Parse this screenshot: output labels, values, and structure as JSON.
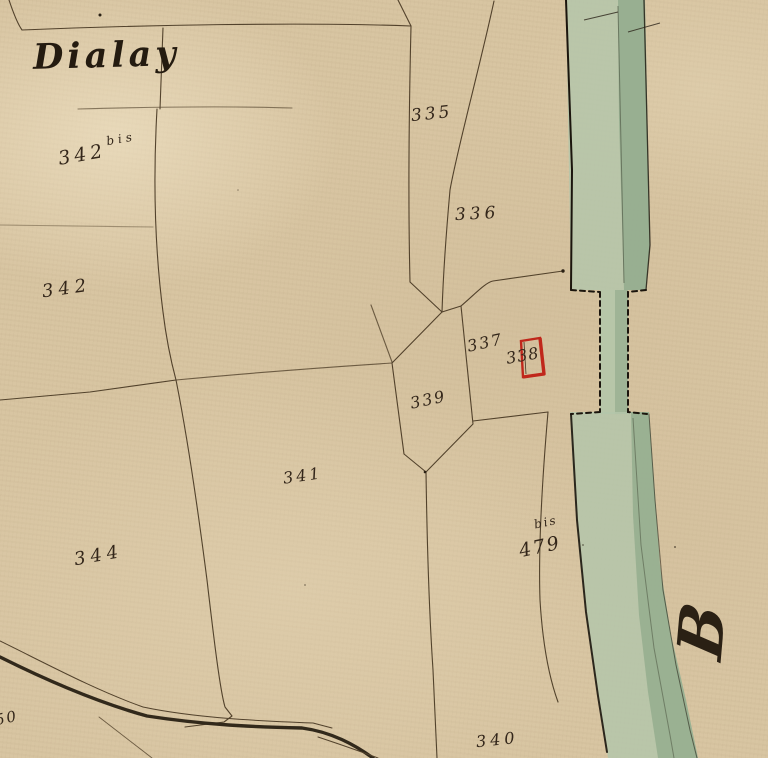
{
  "map": {
    "title_label": "Dialay",
    "margin_letter": "B",
    "parcels": {
      "n335": "335",
      "n336": "336",
      "n337": "337",
      "n338": "338",
      "n339": "339",
      "n341": "341",
      "n342": "342",
      "n342bis_base": "342",
      "n342bis_sup": "bis",
      "n344": "344",
      "n479_base": "479",
      "n479_sup": "bis",
      "n340": "340",
      "n350_partial": "50"
    },
    "colors": {
      "paper": "#d8c5a2",
      "river_light": "#b4c6aa",
      "river_dark": "#90a98b",
      "ink_line": "#473722",
      "ink_text": "#33261a",
      "building_red": "#c0271b",
      "road_dark": "#241c10"
    }
  }
}
